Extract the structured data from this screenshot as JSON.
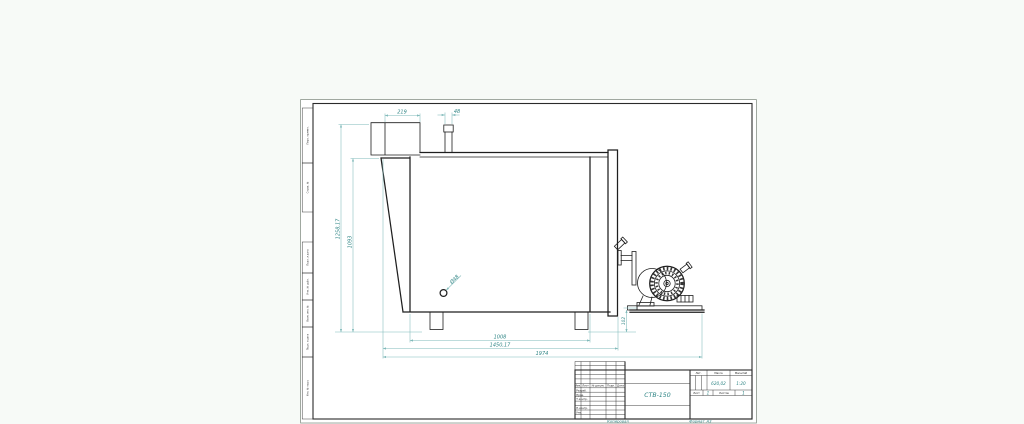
{
  "colors": {
    "paper": "#ffffff",
    "background": "#f7faf7",
    "line": "#1f1f1f",
    "dim_line": "#7fb9b9",
    "dim_text": "#2f8585"
  },
  "drawing": {
    "dim_top_box_width": "219",
    "dim_nozzle_width": "48",
    "dim_overall_height": "1258,17",
    "dim_body_height": "1093",
    "dim_hole_diameter": "Ø48",
    "dim_body_length": "1008",
    "dim_tank_length": "1450,17",
    "dim_overall_length": "1974",
    "dim_base_height": "102"
  },
  "margin_column": {
    "labels": [
      "Перв. примен.",
      "Справ. №",
      "Подп. и дата",
      "Инв. № дубл.",
      "Взам. инв. №",
      "Подп. и дата",
      "Инв. № подл."
    ]
  },
  "title_block": {
    "revision_header": {
      "izm": "Изм.",
      "list": "Лист",
      "doc": "№ докум.",
      "podp": "Подп.",
      "data": "Дата"
    },
    "roles": {
      "razrab": "Разраб.",
      "prov": "Пров.",
      "tkontr": "Т.контр.",
      "nkontr": "Н.контр.",
      "utv": "Утв."
    },
    "doc_name": "СТВ-150",
    "lit_label": "Лит.",
    "mass_label": "Масса",
    "scale_label": "Масштаб",
    "mass_value": "620,02",
    "scale_value": "1:20",
    "sheet_label": "Лист",
    "sheet_value": "1",
    "sheets_label": "Листов",
    "sheets_value": "1"
  },
  "footer": {
    "copied": "Копировал",
    "format_label": "Формат",
    "format_value": "А3"
  }
}
